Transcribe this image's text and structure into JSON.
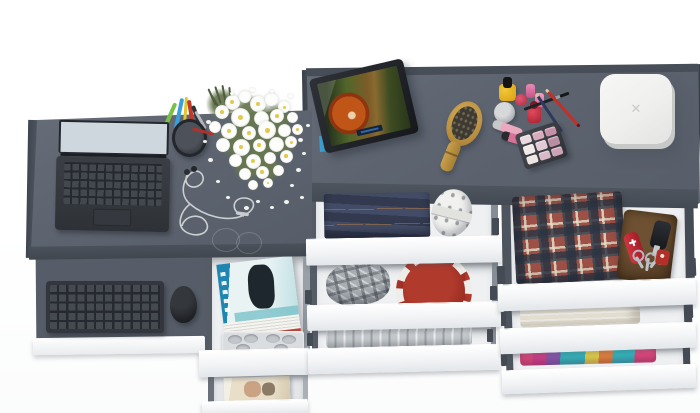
{
  "meta": {
    "kind": "3d-product-render",
    "subject": "Top-down view of a graphite-gray desk and dressing table combo with pulled-out white drawers",
    "view": "overhead"
  },
  "palette": {
    "background": "#ffffff",
    "desk_top": "#5d6470",
    "desk_edge": "#454c56",
    "tray_top": "#565d68",
    "drawer_front": "#fbfcfd",
    "drawer_interior": "#eef0f2",
    "drawer_wall": "#565c66",
    "rail": "#454b54",
    "laptop_body": "#34373c",
    "mouse": "#26282c",
    "jeans": "#3b4359",
    "jeans_stitch": "#c8803e",
    "roll_fabric": "#f1f1ef",
    "plaid_cap": "#a8aeb3",
    "red_box": "#9e2b24",
    "gray_clothes": "#c6cacd",
    "shirt_base": "#9d5046",
    "shirt_navy": "#2a3442",
    "wallet": "#5a4129",
    "knife": "#c32732",
    "towel": "#e9e4d6",
    "tablet_frame": "#23262b",
    "tablet_stand_accent": "#3e9fd0",
    "brush_wood": "#c59b4a",
    "white_box": "#f2f2f0",
    "flower_white": "#fdfdfb",
    "flower_center": "#e5c84e",
    "foliage": "#687850",
    "magazine_cover_blue": "#1f86b2",
    "polish_yellow": "#e8b421",
    "polish_red": "#c43a52",
    "polish_pink": "#d8689a"
  },
  "white_box": {
    "mark": "✕"
  },
  "cosmetics": {
    "palette_pans": [
      "#ead9de",
      "#d9aabb",
      "#c890a8",
      "#f2eae8",
      "#e2cad4",
      "#bb8da2",
      "#eee6e2",
      "#d7bac6",
      "#cda2b6"
    ]
  },
  "scene_inventory": {
    "desk": [
      "open laptop showing snowy mountain wallpaper",
      "pencil cup with colored pens",
      "bouquet of white daisies",
      "white earphones with looping cable"
    ],
    "keyboard_tray": [
      "dark wireless keyboard",
      "black mouse"
    ],
    "magazine_drawers": [
      "stack of magazines with blue cover",
      "molded organizer tray",
      "magazine with beige cover"
    ],
    "dressing_table": [
      "tablet on stand playing an animated movie",
      "wooden hair brush",
      "nail polish bottles",
      "cream jar",
      "lip gloss tubes",
      "makeup pencils and brush",
      "eyeshadow palette",
      "white rounded jewelry box"
    ],
    "middle_drawers": [
      "folded dark jeans",
      "polka-dot fabric roll",
      "gray plaid flat cap",
      "red round box with white trim",
      "folded gray garment"
    ],
    "right_drawers": [
      "folded tartan shirt",
      "brown leather wallet",
      "red pocket knife",
      "key ring with keys",
      "car key fob",
      "red tag",
      "folded white towel",
      "folded colorful clothes"
    ]
  }
}
